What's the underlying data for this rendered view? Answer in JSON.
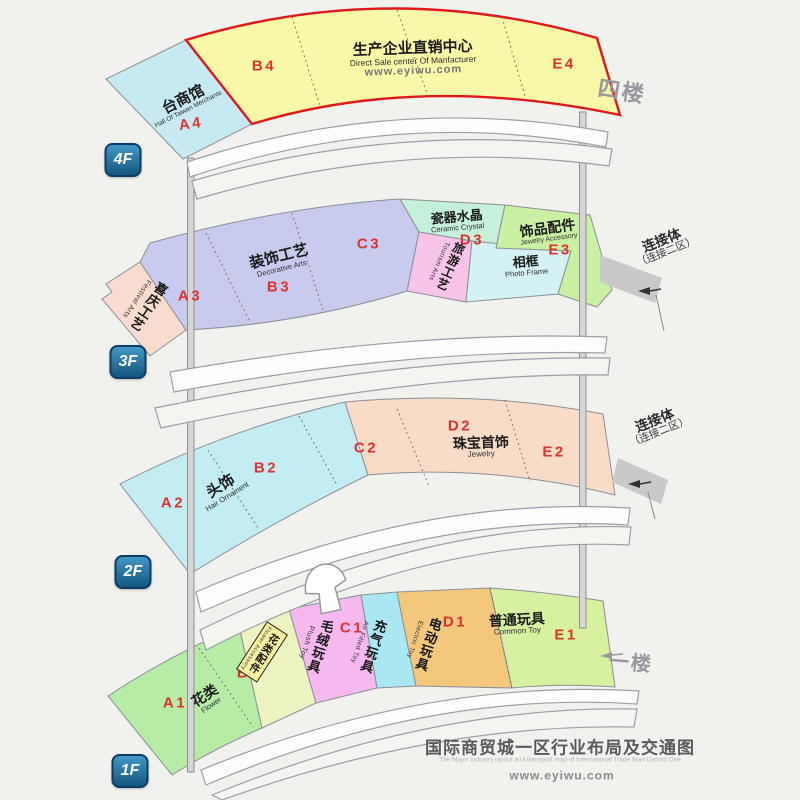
{
  "title_block": {
    "title": "国际商贸城一区行业布局及交通图",
    "subtitle": "The Major Industry layout and transport map of International Trade Mart District One",
    "website": "www.eyiwu.com"
  },
  "connector": {
    "label": "连接体",
    "sub": "（连接二区）"
  },
  "colors": {
    "background": "#f1f1ee",
    "highlight_border": "#e0191f",
    "code_red": "#e0312e",
    "badge_blue": "#14577f",
    "taiwan_hall": "#c6e9f2",
    "direct_sale": "#f8f8a8",
    "festival": "#f9dcd0",
    "decorative": "#c9cbee",
    "ceramic": "#c5f0d9",
    "tourism": "#f8c4ea",
    "photo_frame": "#d4f1f4",
    "jewelry_accessory": "#caf0a4",
    "hair_ornament": "#c3edf3",
    "jewelry": "#f9dcc7",
    "flower": "#b6eca6",
    "flower_accessory": "#eef3c2",
    "plush_toy": "#f5b9ef",
    "air_toy": "#a9e7f2",
    "electric_toy": "#f3c87d",
    "common_toy": "#d8f1a1"
  },
  "floors": [
    {
      "id": "4F",
      "badge": "4F",
      "side_label": "四楼",
      "sections": [
        {
          "code": "A4",
          "zh": "台商馆",
          "en": "Hall Of Taiwan Merchants"
        },
        {
          "code": "B4"
        },
        {
          "zh": "生产企业直销中心",
          "en": "Direct Sale center Of Manfacturer",
          "url": "www.eyiwu.com"
        },
        {
          "code": "E4"
        }
      ]
    },
    {
      "id": "3F",
      "badge": "3F",
      "sections": [
        {
          "code": "A3",
          "zh": "喜庆工艺",
          "en": "Festival Arts"
        },
        {
          "code": "B3",
          "zh": "装饰工艺",
          "en": "Decorative Arts"
        },
        {
          "code": "C3"
        },
        {
          "code": "D3",
          "zh": "瓷器水晶",
          "en": "Ceramic Crystal"
        },
        {
          "zh": "旅游工艺",
          "en": "Tourism Arts"
        },
        {
          "zh": "相框",
          "en": "Photo Frame"
        },
        {
          "code": "E3",
          "zh": "饰品配件",
          "en": "Jewelry Accessory"
        }
      ]
    },
    {
      "id": "2F",
      "badge": "2F",
      "sections": [
        {
          "code": "A2",
          "zh": "头饰",
          "en": "Hair Ornament"
        },
        {
          "code": "B2"
        },
        {
          "code": "C2"
        },
        {
          "code": "D2",
          "zh": "珠宝首饰",
          "en": "Jewelry"
        },
        {
          "code": "E2"
        }
      ]
    },
    {
      "id": "1F",
      "badge": "1F",
      "side_label": "一楼",
      "sections": [
        {
          "code": "A1",
          "zh": "花类",
          "en": "Flower"
        },
        {
          "code": "B1",
          "zh": "花类配件",
          "en": "Flower Accessory"
        },
        {
          "zh": "毛绒玩具",
          "en": "Plush Toy"
        },
        {
          "code": "C1",
          "zh": "充气玩具",
          "en": "Air Filled Toy"
        },
        {
          "code": "D1",
          "zh": "电动玩具",
          "en": "Electric Toy"
        },
        {
          "code": "E1",
          "zh": "普通玩具",
          "en": "Common Toy"
        }
      ]
    }
  ]
}
